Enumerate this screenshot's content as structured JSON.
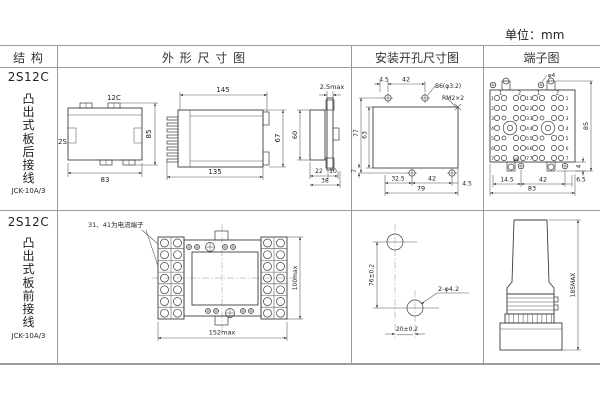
{
  "unit_label": "单位：mm",
  "headers": {
    "structure": "结 构",
    "outline": "外 形 尺 寸 图",
    "mounting": "安装开孔尺寸图",
    "terminal": "端子图"
  },
  "row1": {
    "model": "2S12C",
    "mount_type": "凸出式板后接线",
    "code": "JCK-10A/3",
    "top_view": {
      "terminal_label": "12C",
      "side_label": "2S",
      "width": "83",
      "height": "85"
    },
    "side_view": {
      "width_top": "145",
      "width_bottom": "135",
      "height": "67"
    },
    "end_view": {
      "depth_top": "2.5max",
      "height": "60",
      "d1": "22",
      "d2": "10",
      "d3": "38"
    },
    "mounting": {
      "t1": "4.5",
      "t2": "42",
      "hole_label": "B6(φ3.2)",
      "screw_label": "RM2×2",
      "h1": "77",
      "h2": "63",
      "b0": "7",
      "b1": "32.5",
      "b2": "42",
      "b3": "4.5",
      "total": "79"
    },
    "terminal": {
      "screw_top": "φ4",
      "screw_bottom": "φ8",
      "height": "85",
      "offset": "4",
      "b1": "14.5",
      "b2": "42",
      "b3": "6.5",
      "total": "83",
      "cols": [
        "1",
        "2",
        "1",
        "2"
      ],
      "rows": [
        "1",
        "2",
        "3",
        "4",
        "5",
        "6",
        "7"
      ]
    }
  },
  "row2": {
    "model": "2S12C",
    "mount_type": "凸出式板前接线",
    "code": "JCK-10A/3",
    "note": "31、41为电流端子",
    "front_view": {
      "width": "152max",
      "height": "100max"
    },
    "drill": {
      "v": "76±0.2",
      "h": "20±0.2",
      "holes": "2-φ4.2"
    },
    "side_view": {
      "height": "185MAX"
    }
  }
}
